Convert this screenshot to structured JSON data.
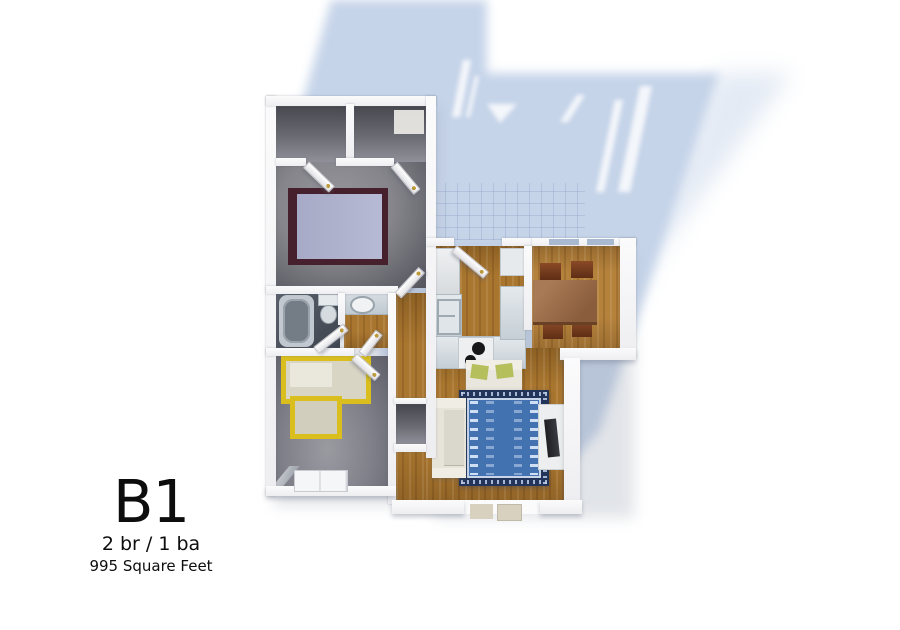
{
  "label": {
    "title": "B1",
    "beds_baths": "2 br / 1 ba",
    "area": "995 Square Feet"
  },
  "floor_plan": {
    "rooms": [
      "bedroom-1",
      "bedroom-2",
      "bathroom",
      "vanity",
      "hallway",
      "kitchen",
      "dining",
      "living",
      "closets"
    ],
    "palette": {
      "cast_shadow": "#c3d2e8",
      "wall": "#f4f4f5",
      "carpet": "#7d7d85",
      "wood_floor": "#a9762f",
      "dining_wood": "#b5823c",
      "bed1_frame": "#46202c",
      "bed1_blanket": "#adb1cc",
      "bed2_accent_yellow": "#d9be1d",
      "rug_border": "#223459",
      "rug_field": "#4273b0",
      "counter": "#cfd7dd",
      "dining_table": "#8d6040",
      "chair": "#73401f",
      "pillow_green": "#b5bf5c",
      "tv_screen": "#26262b",
      "window_glass": "#a9b9cf"
    }
  }
}
